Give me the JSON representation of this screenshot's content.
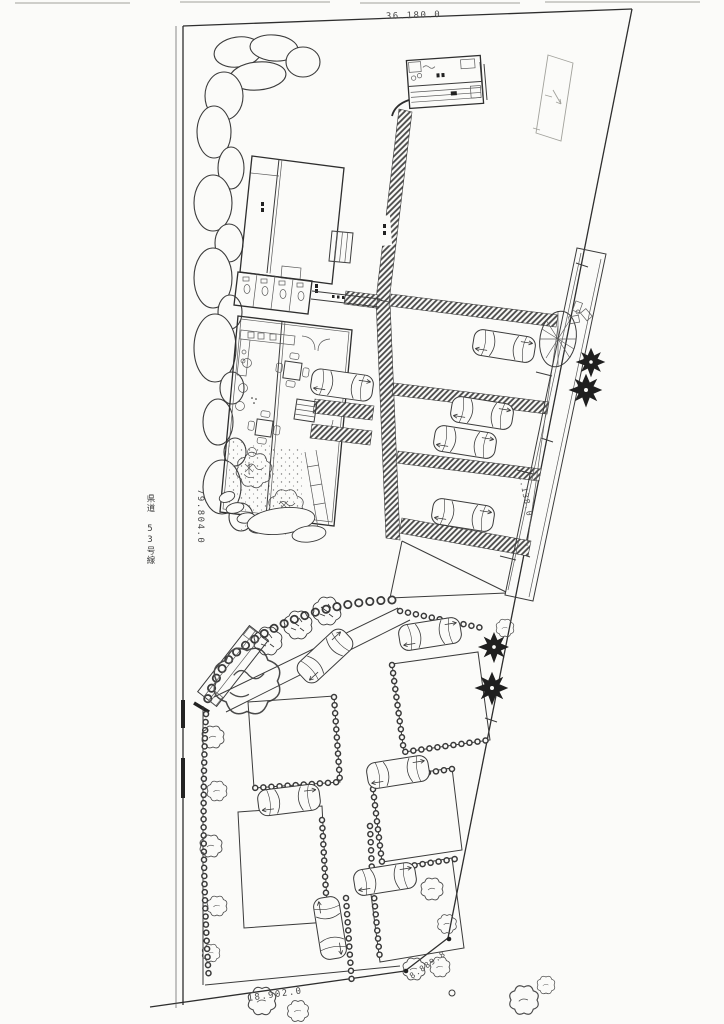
{
  "drawing": {
    "kind": "scanned site plan",
    "labels": {
      "dim_top": "36.180.0",
      "dim_left": "79.804.0",
      "dim_right": "81.138.0",
      "dim_bottom": "18.902.0",
      "dim_corner": "8.889.8",
      "road": "県道 53号線"
    },
    "colors": {
      "paper": "#fbfbf9",
      "ink": "#3b3b3b",
      "hatch": "#474747",
      "tree_dark": "#1f1f1f"
    }
  }
}
